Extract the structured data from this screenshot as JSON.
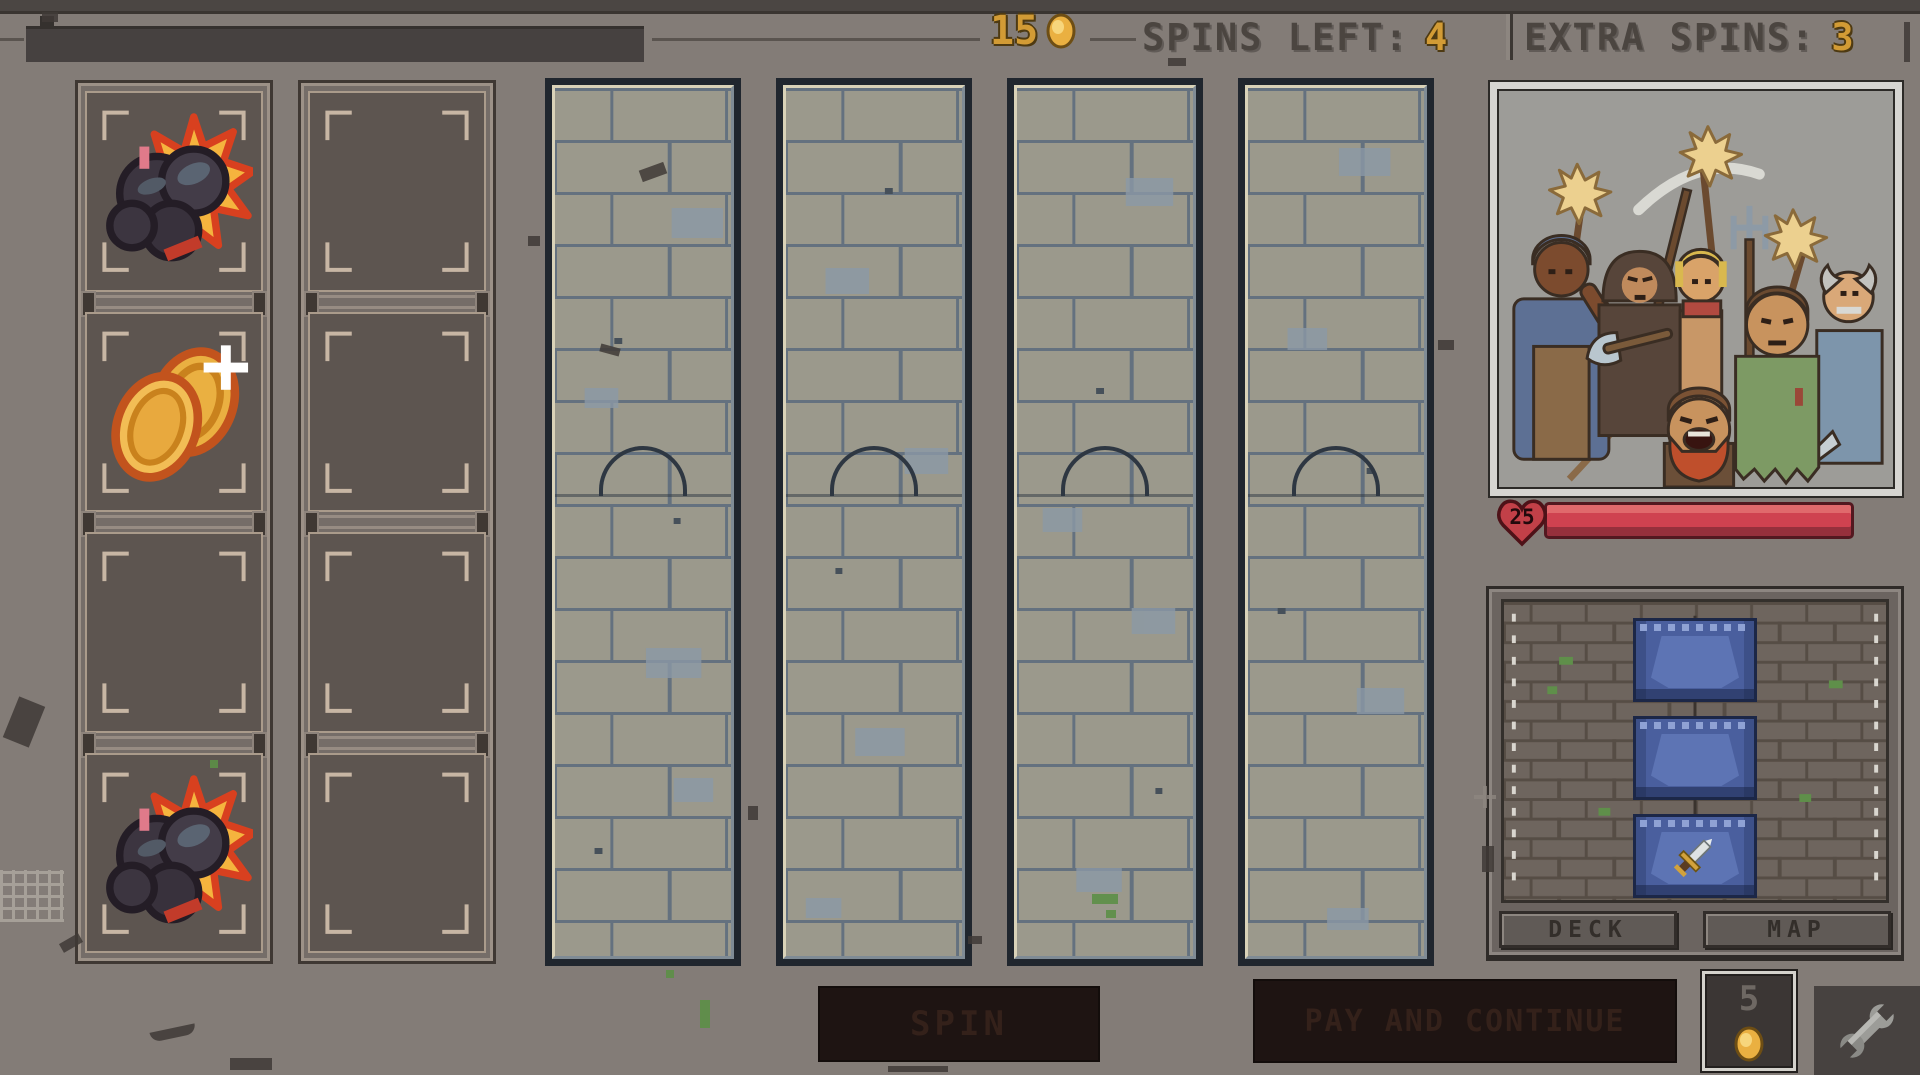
{
  "header": {
    "coin_count": "15",
    "spins_left_label": "SPINS LEFT:",
    "spins_left_value": "4",
    "extra_spins_label": "EXTRA SPINS:",
    "extra_spins_value": "3"
  },
  "inventory": {
    "columns": [
      {
        "slots": [
          "bomb",
          "coins",
          "empty",
          "bomb"
        ]
      },
      {
        "slots": [
          "empty",
          "empty",
          "empty",
          "empty"
        ]
      }
    ]
  },
  "reels": {
    "count": 4,
    "style": "stone-tower-with-arch-door"
  },
  "enemy": {
    "portrait_icon": "angry-mob-with-torches-and-pitchforks",
    "hp_value": "25"
  },
  "deck": {
    "cards": [
      {
        "icon": "card-back"
      },
      {
        "icon": "card-back"
      },
      {
        "icon": "card-back-sword"
      }
    ],
    "deck_button_label": "DECK",
    "map_button_label": "MAP"
  },
  "footer": {
    "spin_button_label": "SPIN",
    "continue_button_label": "PAY AND CONTINUE",
    "continue_cost_value": "5",
    "wrench_icon": "wrench"
  },
  "colors": {
    "gold": "#d29b35",
    "hp_red": "#cf4250",
    "card_blue": "#4a5f9e",
    "bg_grey": "#7e7772"
  }
}
